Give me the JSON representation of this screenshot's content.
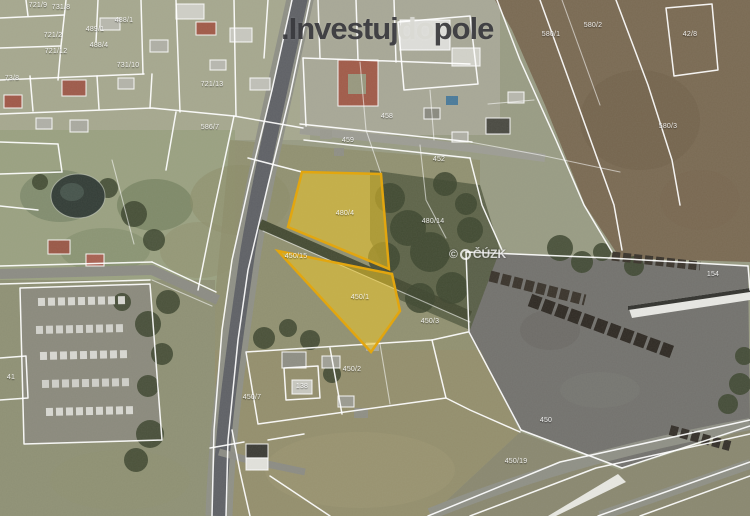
{
  "app": {
    "view": "aerial-cadastral-map"
  },
  "theme": {
    "highlight_fill": "#edc62a",
    "highlight_stroke": "#e2a60f",
    "boundary": "#ffffff",
    "label": "#ffffff"
  },
  "logo": {
    "parts": [
      {
        "text": ".",
        "color": "#3a3a3e"
      },
      {
        "text": "Investuj",
        "color": "#3a3a3e"
      },
      {
        "text": "do",
        "color": "#dadad4"
      },
      {
        "text": "pole",
        "color": "#3a3a3e"
      }
    ]
  },
  "watermark": {
    "copyright": "©",
    "org": "ČÚZK"
  },
  "map": {
    "type": "aerial-cadastral",
    "highlighted_parcels": [
      {
        "id": "480/4"
      },
      {
        "id": "450/1"
      }
    ],
    "labels": [
      {
        "x": 38,
        "y": 6,
        "text": "721/9"
      },
      {
        "x": 61,
        "y": 8,
        "text": "731/8"
      },
      {
        "x": 124,
        "y": 21,
        "text": "488/1"
      },
      {
        "x": 95,
        "y": 30,
        "text": "489/1"
      },
      {
        "x": 53,
        "y": 36,
        "text": "721/2"
      },
      {
        "x": 56,
        "y": 52,
        "text": "721/12"
      },
      {
        "x": 99,
        "y": 46,
        "text": "488/4"
      },
      {
        "x": 128,
        "y": 66,
        "text": "731/10"
      },
      {
        "x": 12,
        "y": 79,
        "text": "73/8"
      },
      {
        "x": 212,
        "y": 85,
        "text": "721/13"
      },
      {
        "x": 210,
        "y": 128,
        "text": "586/7"
      },
      {
        "x": 387,
        "y": 117,
        "text": "458"
      },
      {
        "x": 348,
        "y": 141,
        "text": "459"
      },
      {
        "x": 439,
        "y": 160,
        "text": "452"
      },
      {
        "x": 551,
        "y": 35,
        "text": "580/1"
      },
      {
        "x": 593,
        "y": 26,
        "text": "580/2"
      },
      {
        "x": 668,
        "y": 127,
        "text": "580/3"
      },
      {
        "x": 690,
        "y": 35,
        "text": "42/8"
      },
      {
        "x": 345,
        "y": 214,
        "text": "480/4"
      },
      {
        "x": 296,
        "y": 257,
        "text": "450/15"
      },
      {
        "x": 360,
        "y": 298,
        "text": "450/1"
      },
      {
        "x": 433,
        "y": 222,
        "text": "480/14"
      },
      {
        "x": 430,
        "y": 322,
        "text": "450/3"
      },
      {
        "x": 713,
        "y": 275,
        "text": "154"
      },
      {
        "x": 546,
        "y": 421,
        "text": "450"
      },
      {
        "x": 516,
        "y": 462,
        "text": "450/19"
      },
      {
        "x": 252,
        "y": 398,
        "text": "450/7"
      },
      {
        "x": 352,
        "y": 370,
        "text": "450/2"
      },
      {
        "x": 302,
        "y": 387,
        "text": "138"
      },
      {
        "x": 11,
        "y": 378,
        "text": "41"
      }
    ]
  }
}
